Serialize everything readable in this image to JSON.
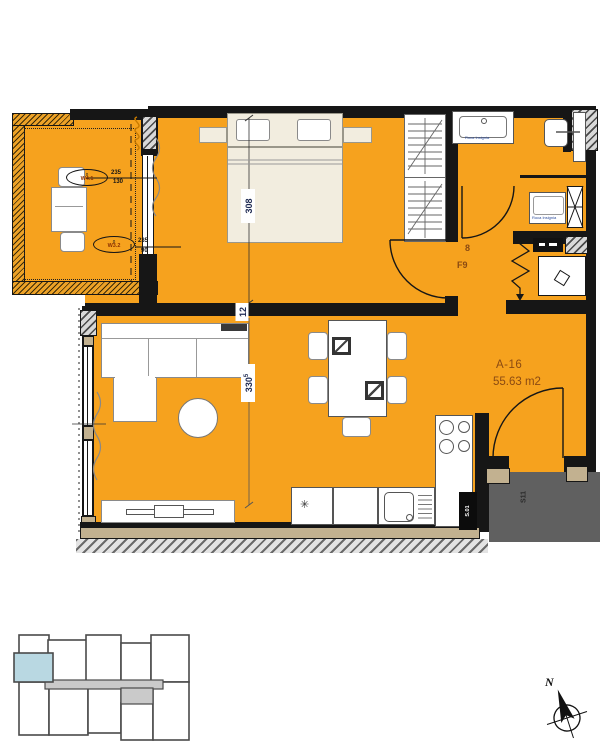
{
  "unit": {
    "code": "A-16",
    "area": "55.63 m2"
  },
  "hall": {
    "code": "F9",
    "symbol": "8"
  },
  "dims": {
    "bedroom": "308",
    "wall": "12",
    "living": "330",
    "living_sup": "5"
  },
  "win1": {
    "zero": "0",
    "id": "W4.1",
    "num": "235",
    "den": "130"
  },
  "win2": {
    "zero": "0",
    "id": "W3.2",
    "num": "235",
    "den": "90"
  },
  "bath": {
    "vanity_label": "Roca Insignia",
    "tub_label": "Roca Insignia"
  },
  "shaft_label": "S.01",
  "corridor_label": "S11",
  "north_label": "N",
  "fridge_symbol": "✳",
  "colors": {
    "floor": "#F6A21E",
    "wall": "#161616",
    "tan": "#C2B190",
    "corridor_gray": "#606060",
    "keyplan_unit": "#B9D8E2",
    "keyplan_corridor": "#CACACA",
    "label_brown": "#8A4A12",
    "dim_navy": "#1E2A52"
  }
}
